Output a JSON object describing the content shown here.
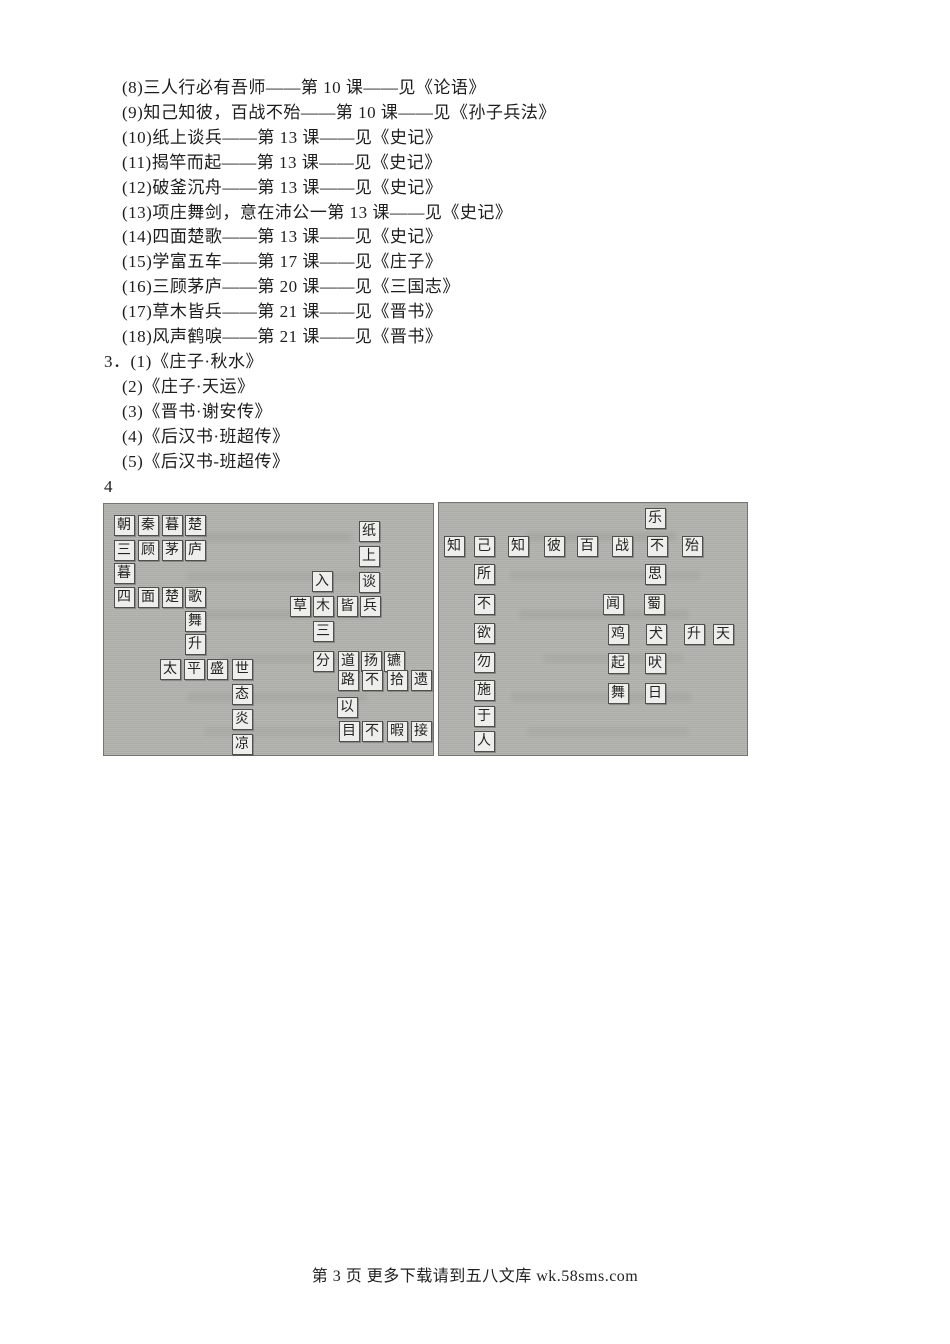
{
  "page": {
    "footer": "第 3 页 更多下载请到五八文库 wk.58sms.com"
  },
  "answers": {
    "lines": [
      {
        "text": "(8)三人行必有吾师——第 10 课——见《论语》",
        "indent": 122
      },
      {
        "text": "(9)知己知彼，百战不殆——第 10 课——见《孙子兵法》",
        "indent": 122
      },
      {
        "text": "(10)纸上谈兵——第 13 课——见《史记》",
        "indent": 122
      },
      {
        "text": "(11)揭竿而起——第 13 课——见《史记》",
        "indent": 122
      },
      {
        "text": "(12)破釜沉舟——第 13 课——见《史记》",
        "indent": 122
      },
      {
        "text": "(13)项庄舞剑，意在沛公一第 13 课——见《史记》",
        "indent": 122
      },
      {
        "text": "(14)四面楚歌——第 13 课——见《史记》",
        "indent": 122
      },
      {
        "text": "(15)学富五车——第 17 课——见《庄子》",
        "indent": 122
      },
      {
        "text": "(16)三顾茅庐——第 20 课——见《三国志》",
        "indent": 122
      },
      {
        "text": "(17)草木皆兵——第 21 课——见《晋书》",
        "indent": 122
      },
      {
        "text": "(18)风声鹤唳——第 21 课——见《晋书》",
        "indent": 122
      },
      {
        "text": "3．(1)《庄子·秋水》",
        "indent": 104
      },
      {
        "text": "(2)《庄子·天运》",
        "indent": 122
      },
      {
        "text": "(3)《晋书·谢安传》",
        "indent": 122
      },
      {
        "text": "(4)《后汉书·班超传》",
        "indent": 122
      },
      {
        "text": "(5)《后汉书-班超传》",
        "indent": 122
      },
      {
        "text": "4",
        "indent": 104
      }
    ]
  },
  "puzzle": {
    "colors": {
      "panel_bg": "#b2b2ae",
      "tile_bg": "#eeeeec",
      "tile_border": "#50504a"
    },
    "panels": [
      {
        "name": "left",
        "tiles": [
          {
            "ch": "朝",
            "x": 20,
            "y": 21
          },
          {
            "ch": "秦",
            "x": 44,
            "y": 21
          },
          {
            "ch": "暮",
            "x": 68,
            "y": 21
          },
          {
            "ch": "楚",
            "x": 91,
            "y": 21
          },
          {
            "ch": "三",
            "x": 20,
            "y": 46
          },
          {
            "ch": "顾",
            "x": 44,
            "y": 46
          },
          {
            "ch": "茅",
            "x": 68,
            "y": 46
          },
          {
            "ch": "庐",
            "x": 91,
            "y": 46
          },
          {
            "ch": "暮",
            "x": 20,
            "y": 69
          },
          {
            "ch": "四",
            "x": 20,
            "y": 93
          },
          {
            "ch": "面",
            "x": 44,
            "y": 93
          },
          {
            "ch": "楚",
            "x": 68,
            "y": 93
          },
          {
            "ch": "歌",
            "x": 91,
            "y": 93
          },
          {
            "ch": "舞",
            "x": 91,
            "y": 117
          },
          {
            "ch": "升",
            "x": 91,
            "y": 140
          },
          {
            "ch": "太",
            "x": 66,
            "y": 165
          },
          {
            "ch": "平",
            "x": 90,
            "y": 165
          },
          {
            "ch": "盛",
            "x": 113,
            "y": 165
          },
          {
            "ch": "世",
            "x": 138,
            "y": 165
          },
          {
            "ch": "态",
            "x": 138,
            "y": 190
          },
          {
            "ch": "炎",
            "x": 138,
            "y": 215
          },
          {
            "ch": "凉",
            "x": 138,
            "y": 240
          },
          {
            "ch": "纸",
            "x": 265,
            "y": 27
          },
          {
            "ch": "上",
            "x": 265,
            "y": 52
          },
          {
            "ch": "入",
            "x": 218,
            "y": 77
          },
          {
            "ch": "谈",
            "x": 265,
            "y": 78
          },
          {
            "ch": "草",
            "x": 196,
            "y": 102
          },
          {
            "ch": "木",
            "x": 219,
            "y": 102
          },
          {
            "ch": "皆",
            "x": 243,
            "y": 102
          },
          {
            "ch": "兵",
            "x": 266,
            "y": 102
          },
          {
            "ch": "三",
            "x": 219,
            "y": 127
          },
          {
            "ch": "分",
            "x": 219,
            "y": 157
          },
          {
            "ch": "道",
            "x": 244,
            "y": 157
          },
          {
            "ch": "扬",
            "x": 267,
            "y": 157
          },
          {
            "ch": "镳",
            "x": 290,
            "y": 157
          },
          {
            "ch": "路",
            "x": 244,
            "y": 176
          },
          {
            "ch": "不",
            "x": 268,
            "y": 176
          },
          {
            "ch": "拾",
            "x": 293,
            "y": 176
          },
          {
            "ch": "遗",
            "x": 317,
            "y": 176
          },
          {
            "ch": "以",
            "x": 243,
            "y": 203
          },
          {
            "ch": "目",
            "x": 245,
            "y": 227
          },
          {
            "ch": "不",
            "x": 268,
            "y": 227
          },
          {
            "ch": "暇",
            "x": 293,
            "y": 227
          },
          {
            "ch": "接",
            "x": 317,
            "y": 227
          }
        ]
      },
      {
        "name": "right",
        "tiles": [
          {
            "ch": "乐",
            "x": 216,
            "y": 15
          },
          {
            "ch": "知",
            "x": 15,
            "y": 43
          },
          {
            "ch": "己",
            "x": 45,
            "y": 43
          },
          {
            "ch": "知",
            "x": 79,
            "y": 43
          },
          {
            "ch": "彼",
            "x": 115,
            "y": 43
          },
          {
            "ch": "百",
            "x": 148,
            "y": 43
          },
          {
            "ch": "战",
            "x": 183,
            "y": 43
          },
          {
            "ch": "不",
            "x": 218,
            "y": 43
          },
          {
            "ch": "殆",
            "x": 253,
            "y": 43
          },
          {
            "ch": "所",
            "x": 45,
            "y": 71
          },
          {
            "ch": "思",
            "x": 216,
            "y": 71
          },
          {
            "ch": "不",
            "x": 45,
            "y": 101
          },
          {
            "ch": "闻",
            "x": 174,
            "y": 101
          },
          {
            "ch": "蜀",
            "x": 215,
            "y": 101
          },
          {
            "ch": "欲",
            "x": 45,
            "y": 130
          },
          {
            "ch": "鸡",
            "x": 179,
            "y": 131
          },
          {
            "ch": "犬",
            "x": 217,
            "y": 131
          },
          {
            "ch": "升",
            "x": 255,
            "y": 131
          },
          {
            "ch": "天",
            "x": 284,
            "y": 131
          },
          {
            "ch": "勿",
            "x": 45,
            "y": 159
          },
          {
            "ch": "起",
            "x": 179,
            "y": 160
          },
          {
            "ch": "吠",
            "x": 216,
            "y": 160
          },
          {
            "ch": "施",
            "x": 45,
            "y": 187
          },
          {
            "ch": "舞",
            "x": 179,
            "y": 190
          },
          {
            "ch": "日",
            "x": 216,
            "y": 190
          },
          {
            "ch": "于",
            "x": 45,
            "y": 213
          },
          {
            "ch": "人",
            "x": 45,
            "y": 238
          }
        ]
      }
    ]
  }
}
